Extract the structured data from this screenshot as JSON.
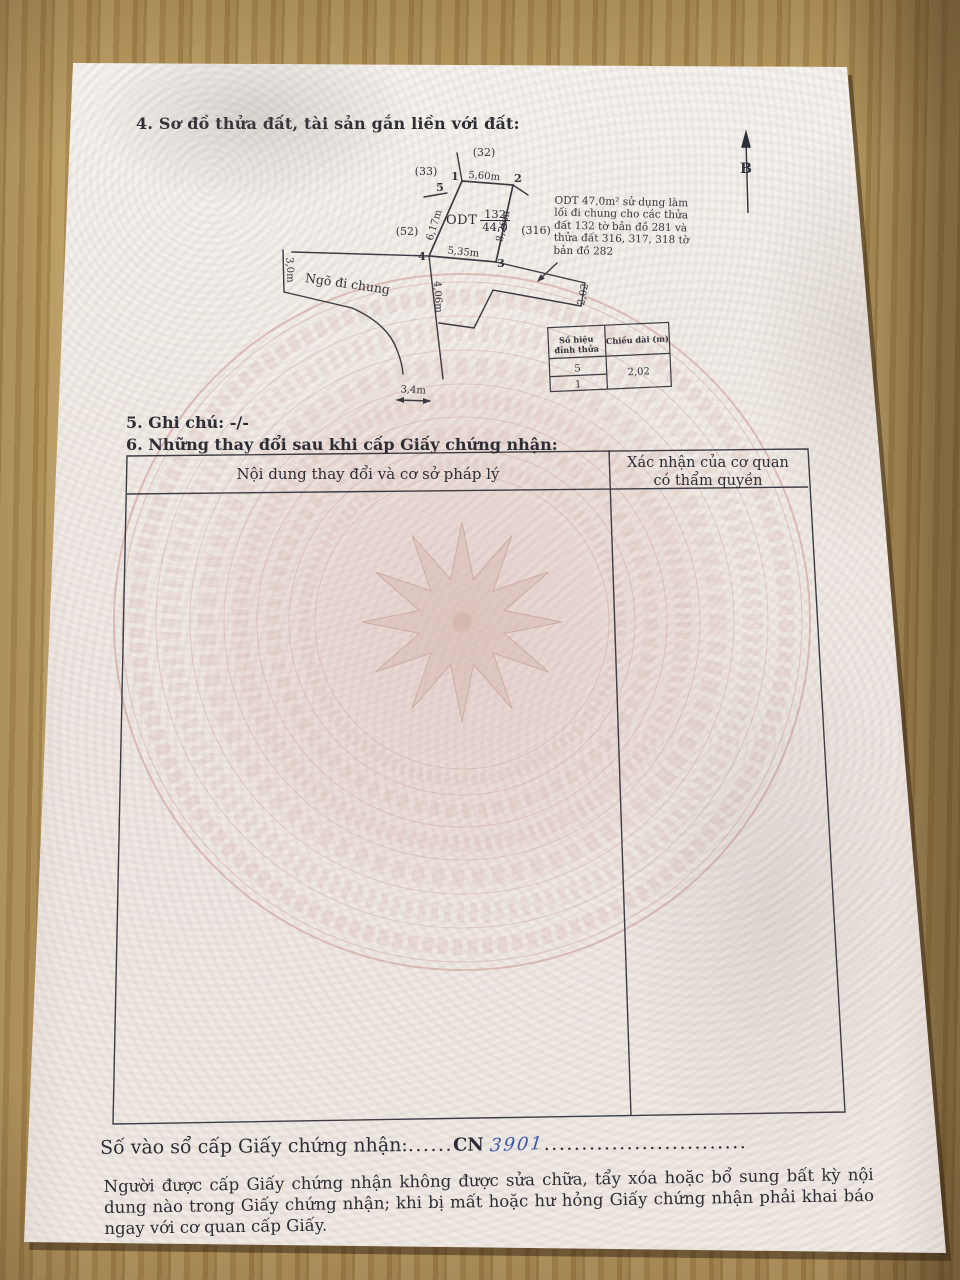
{
  "document": {
    "section4_title": "4. Sơ đồ thửa đất, tài sản gắn liền với đất:",
    "section5": "5. Ghi chú: -/-",
    "section6": "6. Những thay đổi sau khi cấp Giấy chứng nhận:",
    "changes_table": {
      "col1_header": "Nội dung thay đổi và cơ sở pháp lý",
      "col2_header_line1": "Xác nhận của cơ quan",
      "col2_header_line2": "có thẩm quyền"
    },
    "registry_line": {
      "label": "Số vào sổ cấp Giấy chứng nhận:",
      "dots_before": "......",
      "code_printed": "CN",
      "code_handwritten": "3901",
      "dots_after": "..........................."
    },
    "footer_note": "Người được cấp Giấy chứng nhận không được sửa chữa, tẩy xóa hoặc bổ sung bất kỳ nội dung nào trong Giấy chứng nhận; khi bị mất hoặc hư hỏng Giấy chứng nhận phải khai báo ngay với cơ quan cấp Giấy."
  },
  "diagram": {
    "north_label": "B",
    "parcel": {
      "use_code": "ODT",
      "map_number": "132",
      "area": "44,0"
    },
    "vertices": [
      "1",
      "2",
      "3",
      "4",
      "5"
    ],
    "edges": {
      "top": "5,60m",
      "right": "8,26m",
      "bottom": "5,35m",
      "left": "6,17m"
    },
    "dims": {
      "alley_width": "3,0m",
      "leg_length": "4,06m",
      "opening": "3,4m",
      "strip_width": "2,02"
    },
    "neighbors": [
      "(32)",
      "(33)",
      "(52)",
      "(316)"
    ],
    "alley_label": "Ngõ đi chung",
    "note": "ODT 47,0m² sử dụng làm lối đi chung cho các thửa đất 132 tờ bản đồ 281 và thửa đất 316, 317, 318 tờ bản đồ 282",
    "length_table": {
      "col1_line1": "Số hiệu",
      "col1_line2": "đỉnh thửa",
      "col2_header": "Chiều dài (m)",
      "row1": "5",
      "row2": "1",
      "value": "2,02"
    }
  },
  "colors": {
    "ink": "#2d2d36",
    "handwriting_blue": "#3a57a7",
    "pattern_pink": "#d8aaa5",
    "wood": "#b2935c"
  }
}
